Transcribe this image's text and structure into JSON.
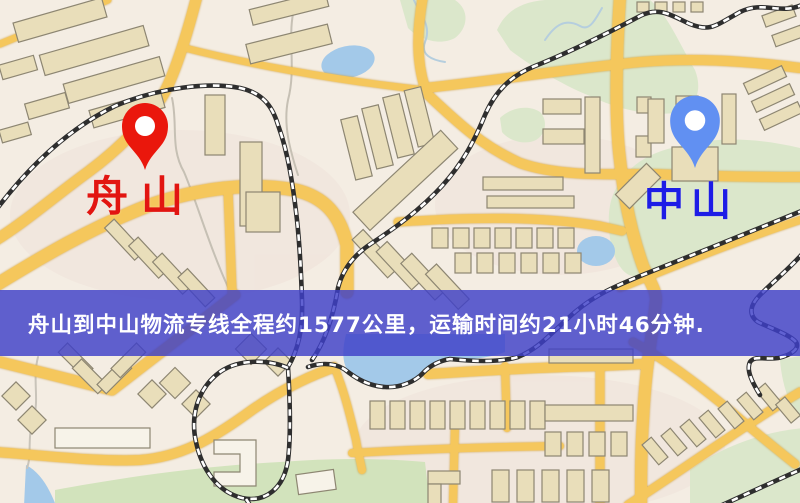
{
  "banner": {
    "text": "舟山到中山物流专线全程约1577公里，运输时间约21小时46分钟.",
    "background_color": "#3e40c8",
    "text_color": "#ffffff"
  },
  "markers": {
    "origin": {
      "label": "舟山",
      "pin_color": "#ea170c",
      "label_color": "#e21511"
    },
    "destination": {
      "label": "中山",
      "pin_color": "#6190f2",
      "label_color": "#1d1de6"
    }
  },
  "map": {
    "kind": "street-map-illustration",
    "colors": {
      "background": "#f4ede3",
      "road": "#f5c75c",
      "building": "#e9deba",
      "building_outline": "#8d8672",
      "green_area": "#dbe7cb",
      "water": "#a3c9e9",
      "railway_dark": "#2e2e2e",
      "railway_light": "#ffffff"
    }
  }
}
